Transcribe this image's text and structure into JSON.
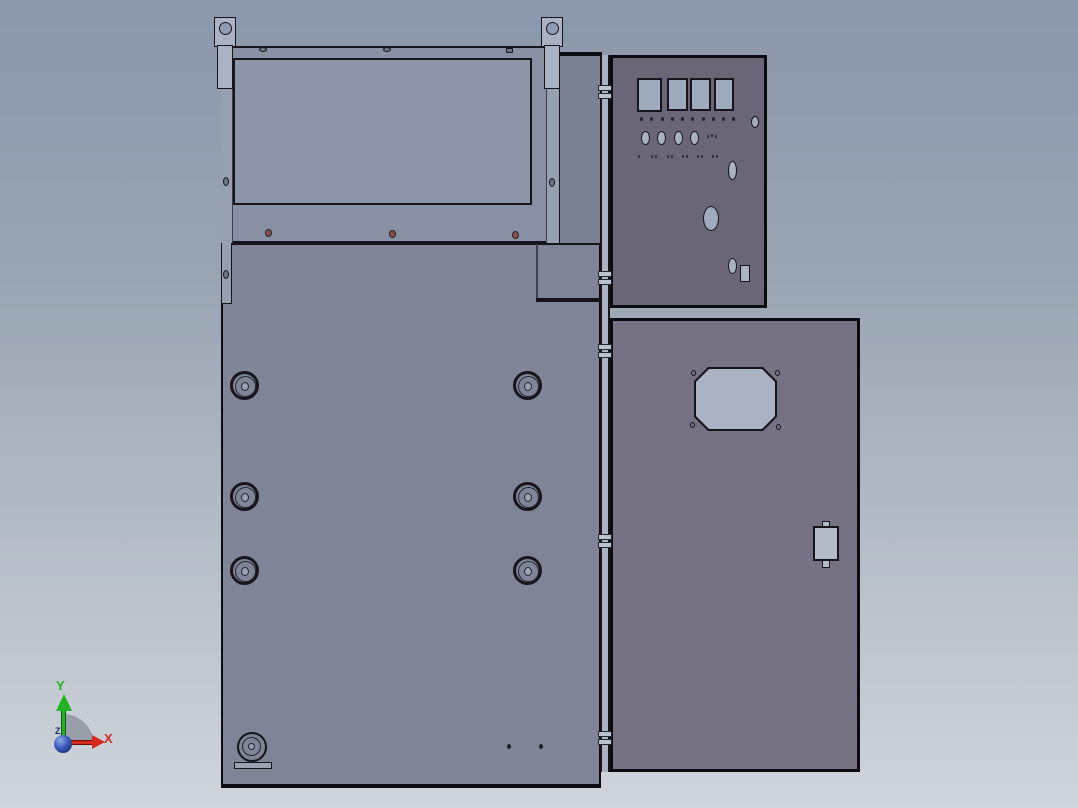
{
  "triad": {
    "x_label": "X",
    "y_label": "Y",
    "z_label": "Z"
  },
  "colors": {
    "bg_top": "#8b98ab",
    "bg_mid1": "#9aa5b3",
    "bg_mid2": "#b3bbc6",
    "bg_bottom": "#d0d5dc",
    "frame": "#8791a3",
    "frame_flange": "#97a0b1",
    "recess": "#8d96a8",
    "door": "#7f8596",
    "filler": "#7a8192",
    "control_panel": "#6b6578",
    "right_door": "#767283",
    "bright_metal": "#aab3c3",
    "window_glass": "#9dabbd",
    "hole_dark": "#6e7687",
    "edge": "#15151b",
    "screw": "#8a5148",
    "axis_x": "#d42a1e",
    "axis_y": "#21b321",
    "axis_z": "#1a2a66",
    "sphere_hi": "#8fa6e0",
    "sphere_mid": "#3a5bbf",
    "sphere_dark": "#0e1f5e"
  },
  "patterns": {
    "rail_holes_oval": [
      [
        259,
        47
      ],
      [
        383,
        47
      ]
    ],
    "rail_holes_square": [
      [
        506,
        48
      ]
    ],
    "frame_holes": [
      [
        223,
        74
      ],
      [
        223,
        177
      ],
      [
        549,
        74
      ],
      [
        549,
        178
      ],
      [
        223,
        270
      ]
    ],
    "rail_screws": [
      [
        265,
        229
      ],
      [
        389,
        230
      ],
      [
        512,
        231
      ]
    ],
    "hinge_knuckles": [
      [
        598,
        85
      ],
      [
        598,
        93
      ],
      [
        598,
        271
      ],
      [
        598,
        279
      ],
      [
        598,
        344
      ],
      [
        598,
        352
      ],
      [
        598,
        534
      ],
      [
        598,
        542
      ],
      [
        598,
        731
      ],
      [
        598,
        739
      ]
    ],
    "ctrl_hole_row": [
      [
        640,
        117
      ],
      [
        650,
        117
      ],
      [
        661,
        117
      ],
      [
        671,
        117
      ],
      [
        681,
        117
      ],
      [
        691,
        117
      ],
      [
        702,
        117
      ],
      [
        712,
        117
      ],
      [
        722,
        117
      ],
      [
        732,
        117
      ]
    ],
    "ctrl_ovals": [
      [
        641,
        131
      ],
      [
        657,
        131
      ],
      [
        674,
        131
      ],
      [
        690,
        131
      ]
    ],
    "ctrl_cluster": [
      [
        707,
        135
      ],
      [
        711,
        134
      ],
      [
        715,
        135
      ]
    ],
    "ctrl_marks": [
      [
        638,
        155
      ],
      [
        651,
        155
      ],
      [
        655,
        155
      ],
      [
        667,
        155
      ],
      [
        671,
        155
      ],
      [
        682,
        155
      ],
      [
        686,
        155
      ],
      [
        697,
        155
      ],
      [
        701,
        155
      ],
      [
        712,
        155
      ],
      [
        716,
        155
      ]
    ],
    "window_corner_holes": [
      [
        691,
        370
      ],
      [
        775,
        370
      ],
      [
        690,
        422
      ],
      [
        776,
        424
      ]
    ],
    "glands": [
      [
        230,
        371
      ],
      [
        513,
        371
      ],
      [
        230,
        482
      ],
      [
        513,
        482
      ],
      [
        230,
        556
      ],
      [
        513,
        556
      ]
    ],
    "door_small_holes": [
      [
        507,
        744
      ],
      [
        539,
        744
      ]
    ]
  }
}
